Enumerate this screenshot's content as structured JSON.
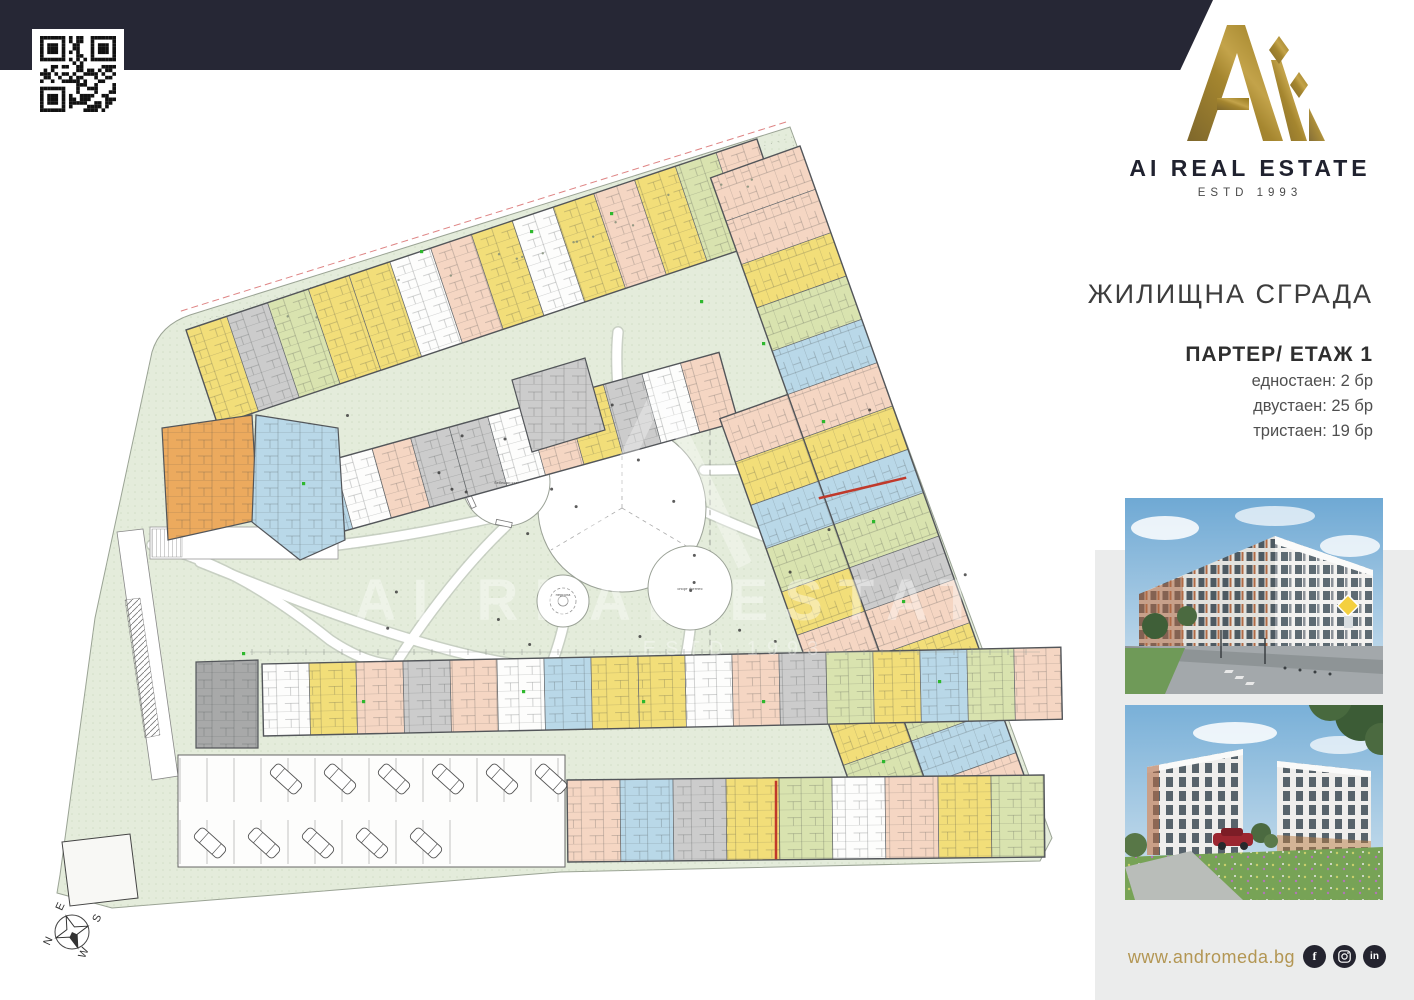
{
  "brand": {
    "name": "AI REAL ESTATE",
    "estd": "ESTD 1993",
    "website": "www.andromeda.bg",
    "gold": "#a5862f",
    "navy": "#262735",
    "social": [
      {
        "name": "facebook",
        "glyph": "f"
      },
      {
        "name": "instagram",
        "glyph": ""
      },
      {
        "name": "linkedin",
        "glyph": "in"
      }
    ]
  },
  "info": {
    "building_title": "ЖИЛИЩНА СГРАДА",
    "floor_title": "ПАРТЕР/ ЕТАЖ 1",
    "stats": [
      "едностаен: 2 бр",
      "двустаен: 25 бр",
      "тристаен: 19 бр"
    ]
  },
  "plan": {
    "palette": {
      "yellow": "#f2de79",
      "orange": "#ecaa5e",
      "blue": "#b9d8e8",
      "salmon": "#f5d6c3",
      "green": "#d9e3af",
      "gray": "#cccccc",
      "darkgray": "#a8a9a9",
      "white": "#fdfdfc",
      "site": "#e4ecdb",
      "lawn_dot": "#c2d0b4",
      "wall": "#53565a",
      "red": "#c0392b",
      "green_marker": "#2eb82e"
    },
    "compass": {
      "n": "N",
      "s": "S",
      "e": "E",
      "w": "W"
    },
    "plaza_labels": {
      "left": "бебешки кът",
      "ring": "пергола",
      "right": "спорт фитнес"
    },
    "watermark": {
      "line1": "AI REAL ESTATE",
      "line2": "ESTD 1993"
    },
    "bands": [
      {
        "name": "top-outer",
        "x": 186,
        "y": 330,
        "angle": -18.5,
        "uw": 43,
        "uh": 100,
        "ox": 0,
        "dy": 0,
        "colors": [
          "yellow",
          "gray",
          "green",
          "yellow",
          "yellow",
          "white",
          "salmon",
          "yellow",
          "white",
          "yellow",
          "salmon",
          "yellow",
          "green",
          "salmon"
        ]
      },
      {
        "name": "top-inner",
        "x": 295,
        "y": 470,
        "angle": -15.5,
        "uw": 40,
        "uh": 72,
        "ox": 0,
        "dy": 0,
        "colors": [
          "blue",
          "white",
          "salmon",
          "gray",
          "gray",
          "white",
          "salmon",
          "yellow",
          "gray",
          "white",
          "salmon"
        ]
      },
      {
        "name": "right-outer",
        "x": 800,
        "y": 146,
        "angle": 70.4,
        "uw": 46,
        "uh": 95,
        "ox": 0,
        "dy": 0,
        "colors": [
          "salmon",
          "salmon",
          "yellow",
          "green",
          "blue",
          "salmon",
          "yellow",
          "blue",
          "green",
          "gray",
          "salmon",
          "yellow",
          "green",
          "blue",
          "salmon"
        ]
      },
      {
        "name": "right-inner",
        "x": 800,
        "y": 146,
        "angle": 70.4,
        "uw": 46,
        "uh": 72,
        "ox": 230,
        "dy": 95,
        "colors": [
          "salmon",
          "yellow",
          "blue",
          "green",
          "yellow",
          "salmon",
          "gray",
          "yellow",
          "green"
        ]
      },
      {
        "name": "bottom-upper",
        "x": 262,
        "y": 664,
        "angle": -1.2,
        "uw": 47,
        "uh": 72,
        "ox": 0,
        "dy": 0,
        "colors": [
          "white",
          "yellow",
          "salmon",
          "gray",
          "salmon",
          "white",
          "blue",
          "yellow",
          "yellow",
          "white",
          "salmon",
          "gray",
          "green",
          "yellow",
          "blue",
          "green",
          "salmon"
        ]
      },
      {
        "name": "bottom-commercial",
        "x": 567,
        "y": 780,
        "angle": -0.6,
        "uw": 53,
        "uh": 82,
        "ox": 0,
        "dy": 0,
        "colors": [
          "salmon",
          "blue",
          "gray",
          "yellow",
          "green",
          "white",
          "salmon",
          "yellow",
          "green"
        ]
      }
    ],
    "blocks": [
      {
        "name": "orange-cluster",
        "pts": "162,428 252,415 258,520 168,540",
        "color": "orange"
      },
      {
        "name": "blue-cluster",
        "pts": "256,415 338,428 345,540 300,560 252,522",
        "color": "blue"
      },
      {
        "name": "gray-cluster",
        "pts": "512,380 585,358 605,430 532,452",
        "color": "gray"
      },
      {
        "name": "dark-entry",
        "pts": "196,662 258,660 258,748 196,748",
        "color": "darkgray"
      }
    ],
    "green_markers": [
      [
        420,
        250
      ],
      [
        530,
        230
      ],
      [
        610,
        212
      ],
      [
        700,
        300
      ],
      [
        762,
        342
      ],
      [
        822,
        420
      ],
      [
        872,
        520
      ],
      [
        902,
        600
      ],
      [
        938,
        680
      ],
      [
        302,
        482
      ],
      [
        362,
        700
      ],
      [
        522,
        690
      ],
      [
        642,
        700
      ],
      [
        762,
        700
      ],
      [
        882,
        760
      ],
      [
        242,
        652
      ]
    ],
    "red_lines": [
      [
        820,
        498,
        905,
        478
      ],
      [
        776,
        782,
        776,
        858
      ]
    ],
    "parking": {
      "top_row_x": [
        286,
        340,
        394,
        448,
        502,
        551
      ],
      "top_row_y": 779,
      "bottom_row_x": [
        210,
        264,
        318,
        372,
        426
      ],
      "bottom_row_y": 843
    }
  }
}
